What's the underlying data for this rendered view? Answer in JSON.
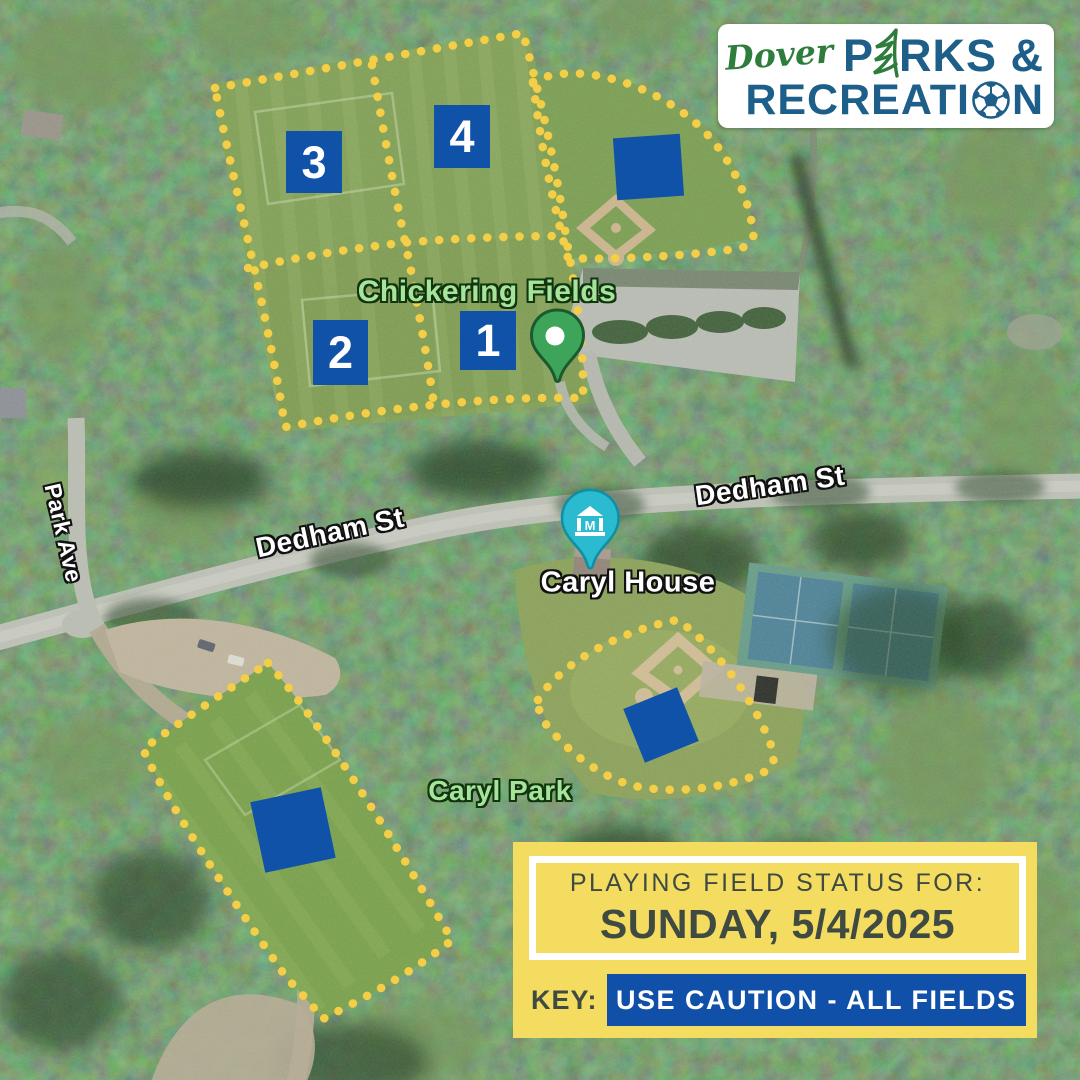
{
  "logo": {
    "dover": "Dover",
    "parks_p": "P",
    "parks_rest": "RKS &",
    "rec_prefix": "RECREATI",
    "rec_suffix": "N"
  },
  "map_labels": {
    "chickering_fields": "Chickering Fields",
    "caryl_house": "Caryl House",
    "caryl_park": "Caryl Park",
    "dedham_st_west": "Dedham St",
    "dedham_st_east": "Dedham St",
    "park_ave": "Park Ave"
  },
  "markers": [
    {
      "id": "field-1",
      "label": "1"
    },
    {
      "id": "field-2",
      "label": "2"
    },
    {
      "id": "field-3",
      "label": "3"
    },
    {
      "id": "field-4",
      "label": "4"
    },
    {
      "id": "north-ballfield",
      "label": ""
    },
    {
      "id": "caryl-ballfield",
      "label": ""
    },
    {
      "id": "southwest-field",
      "label": ""
    }
  ],
  "icons": {
    "museum_marker_glyph": "M"
  },
  "status_panel": {
    "title": "PLAYING FIELD STATUS FOR:",
    "date": "SUNDAY, 5/4/2025",
    "key_label": "KEY:",
    "key_value": "USE CAUTION - ALL FIELDS"
  },
  "colors": {
    "marker_blue": "#1152A9",
    "dot_yellow": "#F5CE48",
    "panel_yellow": "#F3DC60",
    "status_blue": "#1150A8",
    "status_text": "#3F4B42",
    "logo_blue": "#1E5F89",
    "logo_green": "#2F7D3C",
    "pin_green": "#3CA55A",
    "pin_teal": "#2ABBD1",
    "label_green": "#A6E49C"
  }
}
